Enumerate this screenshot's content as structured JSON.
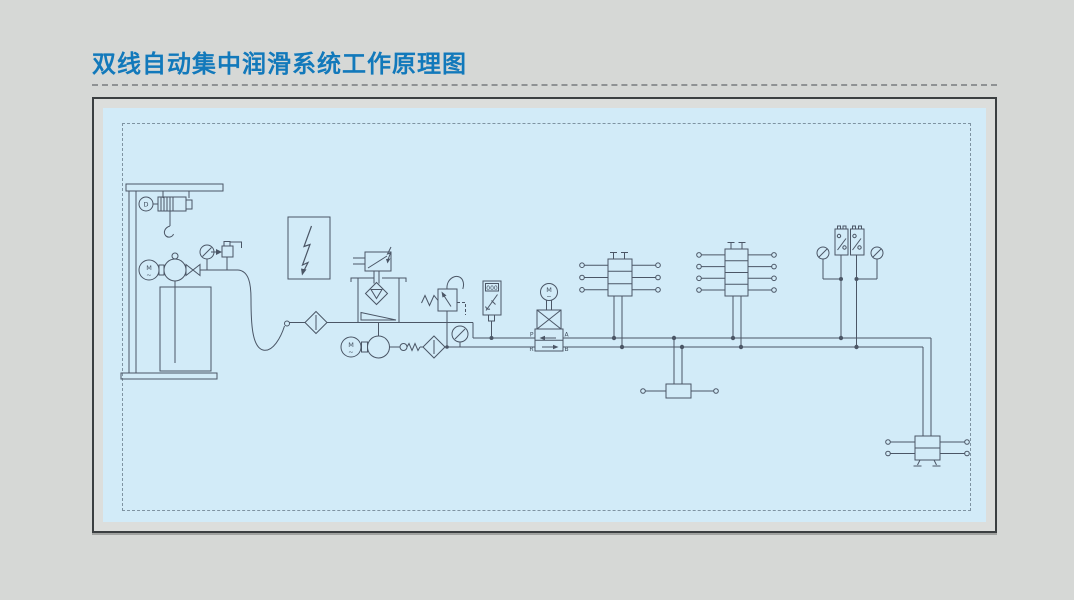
{
  "title": "双线自动集中润滑系统工作原理图",
  "colors": {
    "title": "#1279bb",
    "page_bg": "#d6d8d6",
    "panel_bg": "#d2ebf8",
    "frame": "#3b3f41",
    "line": "#4b5666"
  },
  "diagram": {
    "labels": {
      "hoist_motor": "D",
      "motor": "M",
      "ac_mark": "~",
      "counter": "000",
      "port_p": "P",
      "port_a": "A",
      "port_r": "R",
      "port_b": "B"
    },
    "components": [
      {
        "id": "hoist-stand"
      },
      {
        "id": "electric-hoist"
      },
      {
        "id": "drum-pump-unit"
      },
      {
        "id": "discharge-pressure-gauge"
      },
      {
        "id": "discharge-sensor"
      },
      {
        "id": "flexible-hose"
      },
      {
        "id": "fill-filter"
      },
      {
        "id": "electric-control-box"
      },
      {
        "id": "reservoir"
      },
      {
        "id": "level-switch"
      },
      {
        "id": "strainer"
      },
      {
        "id": "supply-pump-unit"
      },
      {
        "id": "check-valve"
      },
      {
        "id": "suction-filter"
      },
      {
        "id": "relief-valve"
      },
      {
        "id": "line-pressure-gauge"
      },
      {
        "id": "pressure-controller"
      },
      {
        "id": "motorized-reversing-valve"
      },
      {
        "id": "dual-line-distributor-3-section"
      },
      {
        "id": "dual-line-distributor-4-section"
      },
      {
        "id": "dual-line-distributor-1-section"
      },
      {
        "id": "dual-line-end-distributor"
      },
      {
        "id": "pressure-switch-1"
      },
      {
        "id": "pressure-switch-2"
      },
      {
        "id": "end-gauge-left"
      },
      {
        "id": "end-gauge-right"
      }
    ]
  }
}
